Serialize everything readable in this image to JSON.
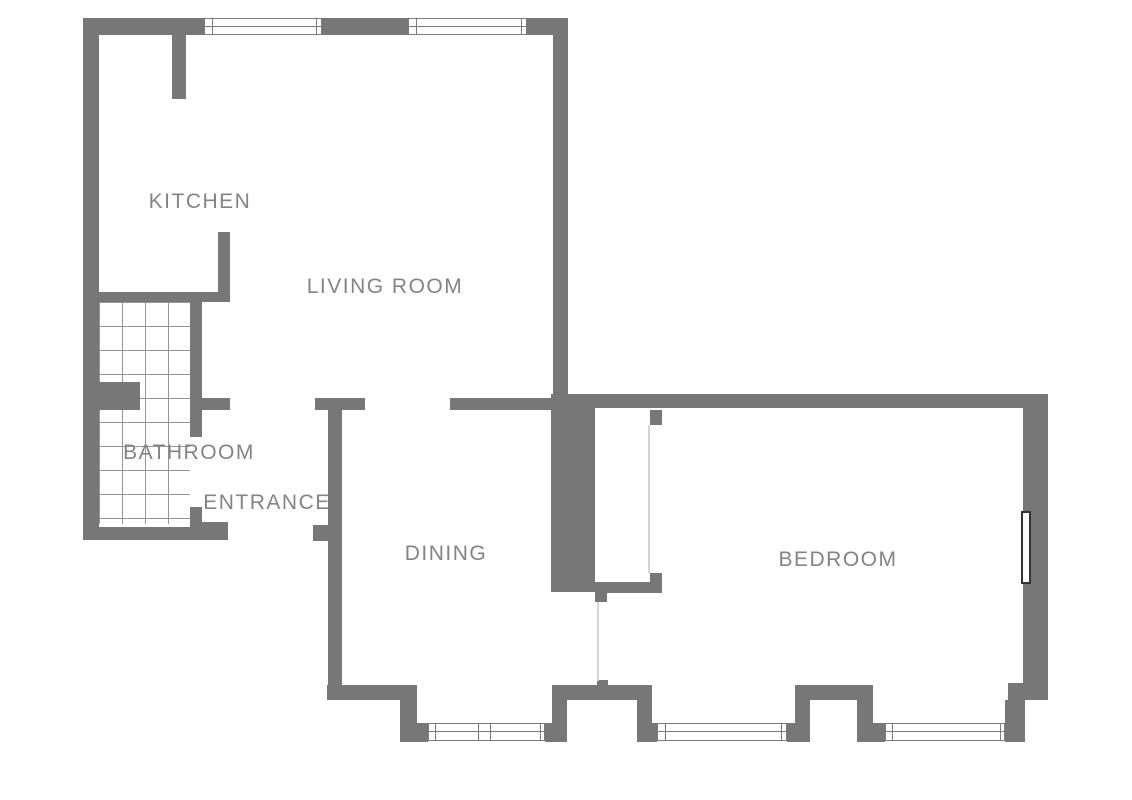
{
  "title": "Apartment floor plan",
  "colors": {
    "wall": "#777777",
    "window_frame": "#7b7b7b",
    "tile_line": "#969696",
    "faint_line": "#d5d5d5",
    "door_border": "#333333",
    "label": "#848484",
    "background": "#ffffff"
  },
  "rooms": [
    {
      "id": "kitchen",
      "label": "KITCHEN",
      "cx": 200,
      "cy": 202
    },
    {
      "id": "living-room",
      "label": "LIVING ROOM",
      "cx": 385,
      "cy": 287
    },
    {
      "id": "bathroom",
      "label": "BATHROOM",
      "cx": 189,
      "cy": 453
    },
    {
      "id": "entrance",
      "label": "ENTRANCE",
      "cx": 267,
      "cy": 503
    },
    {
      "id": "dining",
      "label": "DINING",
      "cx": 446,
      "cy": 554
    },
    {
      "id": "bedroom",
      "label": "BEDROOM",
      "cx": 838,
      "cy": 560
    }
  ],
  "floorplan": {
    "canvas": {
      "width": 1132,
      "height": 800
    },
    "walls": [
      {
        "n": "top-wall-left",
        "x": 83,
        "y": 18,
        "w": 121,
        "h": 17
      },
      {
        "n": "top-wall-mid",
        "x": 322,
        "y": 18,
        "w": 86,
        "h": 17
      },
      {
        "n": "top-wall-right",
        "x": 527,
        "y": 18,
        "w": 41,
        "h": 17
      },
      {
        "n": "left-wall",
        "x": 83,
        "y": 18,
        "w": 16,
        "h": 522
      },
      {
        "n": "living-room-right-wall",
        "x": 553,
        "y": 18,
        "w": 15,
        "h": 376
      },
      {
        "n": "kitchen-top-stub-wall",
        "x": 172,
        "y": 35,
        "w": 14,
        "h": 64
      },
      {
        "n": "kitchen-divider-wall",
        "x": 218,
        "y": 232,
        "w": 12,
        "h": 70
      },
      {
        "n": "bathroom-top-wall",
        "x": 83,
        "y": 292,
        "w": 147,
        "h": 10
      },
      {
        "n": "bathroom-right-wall",
        "x": 190,
        "y": 302,
        "w": 12,
        "h": 135
      },
      {
        "n": "bathroom-partition-block",
        "x": 99,
        "y": 382,
        "w": 41,
        "h": 28
      },
      {
        "n": "bathroom-door-stub",
        "x": 202,
        "y": 398,
        "w": 28,
        "h": 12
      },
      {
        "n": "bathroom-door-jamb",
        "x": 190,
        "y": 507,
        "w": 12,
        "h": 33
      },
      {
        "n": "entrance-bottom-wall",
        "x": 83,
        "y": 527,
        "w": 144,
        "h": 13
      },
      {
        "n": "entrance-bottom-wall-chunk",
        "x": 202,
        "y": 522,
        "w": 26,
        "h": 18
      },
      {
        "n": "entrance-door-stub",
        "x": 313,
        "y": 525,
        "w": 15,
        "h": 16
      },
      {
        "n": "dining-wall-tbar",
        "x": 315,
        "y": 398,
        "w": 50,
        "h": 12
      },
      {
        "n": "dining-left-wall",
        "x": 328,
        "y": 410,
        "w": 14,
        "h": 275
      },
      {
        "n": "living-dining-wall",
        "x": 450,
        "y": 398,
        "w": 118,
        "h": 12
      },
      {
        "n": "hall-thick-wall-block",
        "x": 551,
        "y": 405,
        "w": 44,
        "h": 187
      },
      {
        "n": "bedroom-top-wall",
        "x": 551,
        "y": 394,
        "w": 497,
        "h": 14
      },
      {
        "n": "bedroom-door-bottom-bar",
        "x": 595,
        "y": 582,
        "w": 67,
        "h": 11
      },
      {
        "n": "bedroom-door-bottom-stub",
        "x": 595,
        "y": 593,
        "w": 12,
        "h": 9
      },
      {
        "n": "bedroom-door-jamb-top",
        "x": 650,
        "y": 410,
        "w": 12,
        "h": 15
      },
      {
        "n": "bedroom-door-jamb-bottom",
        "x": 650,
        "y": 573,
        "w": 12,
        "h": 10
      },
      {
        "n": "divider-end-stub",
        "x": 597,
        "y": 680,
        "w": 11,
        "h": 7
      },
      {
        "n": "dining-bottom-wall",
        "x": 327,
        "y": 685,
        "w": 90,
        "h": 15
      },
      {
        "n": "dining-bottom-leg",
        "x": 400,
        "y": 700,
        "w": 17,
        "h": 42
      },
      {
        "n": "window-stub-a",
        "x": 417,
        "y": 723,
        "w": 11,
        "h": 19
      },
      {
        "n": "window-stub-b",
        "x": 545,
        "y": 723,
        "w": 7,
        "h": 19
      },
      {
        "n": "balcony-door-left-leg",
        "x": 552,
        "y": 700,
        "w": 15,
        "h": 42
      },
      {
        "n": "balcony-door-header",
        "x": 552,
        "y": 685,
        "w": 100,
        "h": 15
      },
      {
        "n": "balcony-door-right-leg",
        "x": 637,
        "y": 700,
        "w": 15,
        "h": 42
      },
      {
        "n": "window-stub-c",
        "x": 652,
        "y": 723,
        "w": 5,
        "h": 19
      },
      {
        "n": "window-stub-d",
        "x": 787,
        "y": 723,
        "w": 8,
        "h": 19
      },
      {
        "n": "bedroom-door2-left-leg",
        "x": 795,
        "y": 700,
        "w": 15,
        "h": 42
      },
      {
        "n": "bedroom-door2-header",
        "x": 795,
        "y": 685,
        "w": 78,
        "h": 15
      },
      {
        "n": "bedroom-door2-right-leg",
        "x": 857,
        "y": 700,
        "w": 16,
        "h": 42
      },
      {
        "n": "window-stub-e",
        "x": 873,
        "y": 723,
        "w": 12,
        "h": 19
      },
      {
        "n": "bedroom-corner-leg",
        "x": 1005,
        "y": 700,
        "w": 20,
        "h": 42
      },
      {
        "n": "bedroom-corner-connector",
        "x": 1008,
        "y": 683,
        "w": 40,
        "h": 17
      },
      {
        "n": "bedroom-right-wall",
        "x": 1023,
        "y": 394,
        "w": 25,
        "h": 306
      }
    ],
    "windows": [
      {
        "n": "kitchen-window",
        "x": 204,
        "y": 18,
        "w": 118,
        "h": 17,
        "m": [
          7,
          111
        ]
      },
      {
        "n": "living-room-window",
        "x": 408,
        "y": 18,
        "w": 119,
        "h": 17,
        "m": [
          7,
          112
        ]
      },
      {
        "n": "dining-window",
        "x": 428,
        "y": 723,
        "w": 117,
        "h": 18,
        "m": [
          6,
          49,
          61,
          111
        ]
      },
      {
        "n": "bedroom-window-left",
        "x": 657,
        "y": 723,
        "w": 130,
        "h": 18,
        "m": [
          7,
          123
        ]
      },
      {
        "n": "bedroom-window-right",
        "x": 885,
        "y": 723,
        "w": 120,
        "h": 18,
        "m": [
          6,
          114
        ]
      }
    ],
    "faint_lines": [
      {
        "n": "bedroom-door-leaf-line",
        "x": 648,
        "y": 425,
        "w": 2,
        "h": 148
      },
      {
        "n": "dining-bedroom-divider-line",
        "x": 597,
        "y": 602,
        "w": 2,
        "h": 79
      }
    ],
    "door_panels": [
      {
        "n": "bedroom-right-door-panel",
        "x": 1021,
        "y": 511,
        "w": 10,
        "h": 73
      }
    ],
    "tiles": {
      "n": "bathroom-tile-floor",
      "x": 99,
      "y": 302,
      "w": 91,
      "h": 222
    }
  }
}
